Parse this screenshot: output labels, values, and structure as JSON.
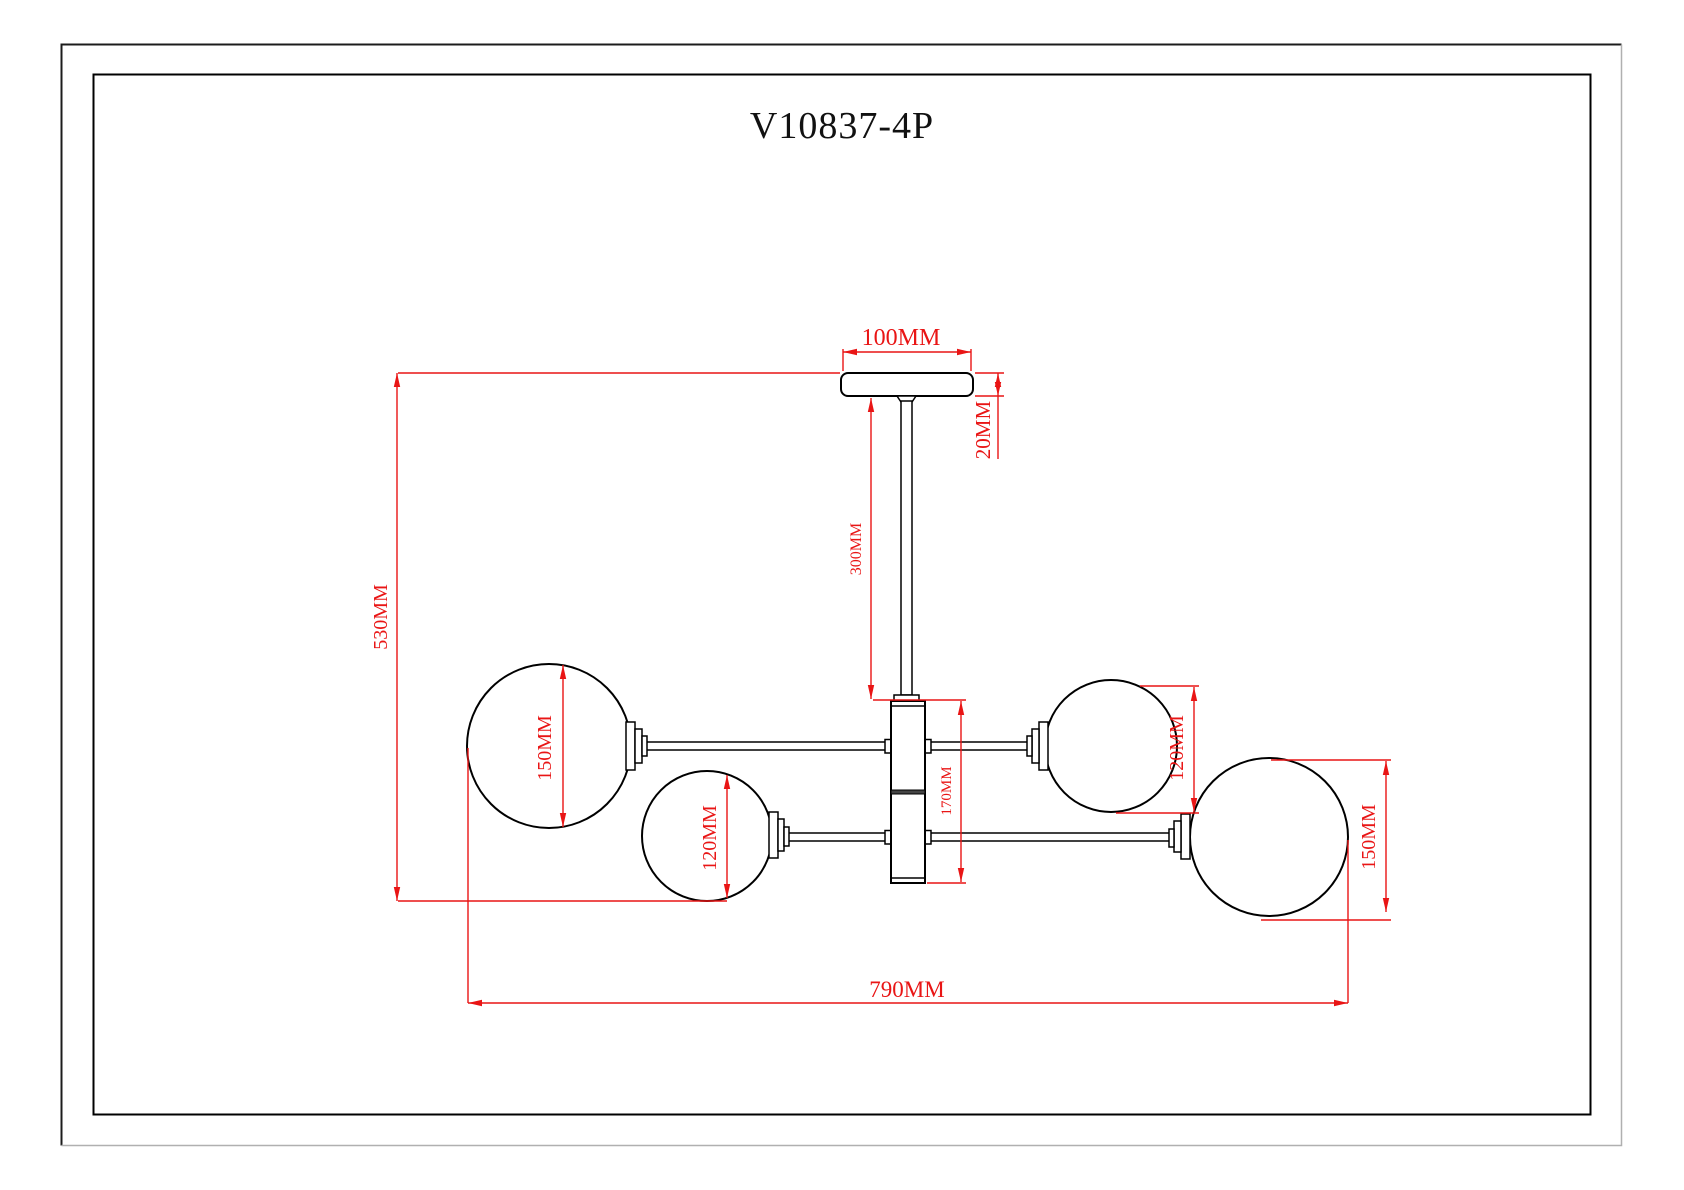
{
  "title": "V10837-4P",
  "drawing": {
    "kind": "ceiling-lamp-dimension-drawing",
    "lamp_count": 4,
    "colors": {
      "linework": "#000000",
      "dimension": "#e91515",
      "background": "#ffffff"
    },
    "labels": {
      "canopy_width": "100MM",
      "canopy_height": "20MM",
      "stem_length": "300MM",
      "overall_height": "530MM",
      "overall_width": "790MM",
      "body_height": "170MM",
      "globe_upper_left": "150MM",
      "globe_lower_left": "120MM",
      "globe_upper_right": "120MM",
      "globe_lower_right": "150MM"
    }
  }
}
